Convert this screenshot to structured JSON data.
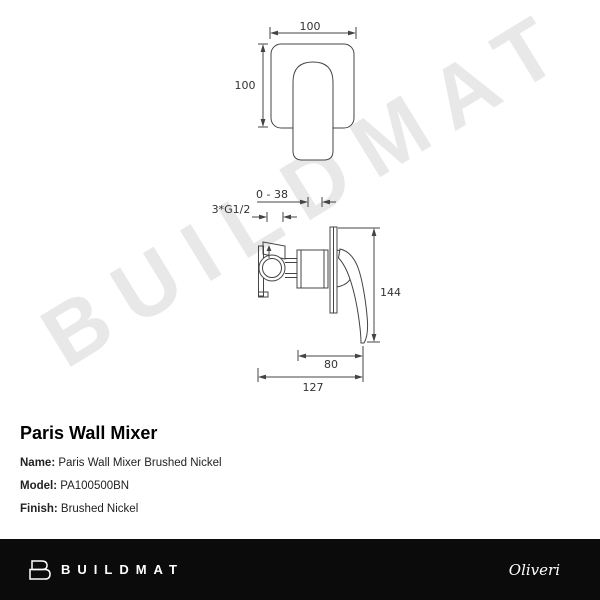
{
  "watermark": "BUILDMAT",
  "drawing": {
    "front_view": {
      "width_label": "100",
      "height_label": "100"
    },
    "side_view": {
      "depth_range_label": "0 - 38",
      "thread_label": "3*G1/2",
      "height_label": "144",
      "handle_depth_label": "80",
      "total_depth_label": "127"
    }
  },
  "product": {
    "title": "Paris Wall Mixer",
    "fields": [
      {
        "label": "Name:",
        "value": "Paris Wall Mixer Brushed Nickel"
      },
      {
        "label": "Model:",
        "value": "PA100500BN"
      },
      {
        "label": "Finish:",
        "value": "Brushed Nickel"
      }
    ]
  },
  "footer": {
    "brand": "BUILDMAT",
    "partner_brand": "Oliveri",
    "background_color": "#0b0b0b",
    "text_color": "#ffffff"
  },
  "colors": {
    "drawing_line": "#444444",
    "dimension_text": "#333333",
    "watermark": "#e8e8e8"
  }
}
